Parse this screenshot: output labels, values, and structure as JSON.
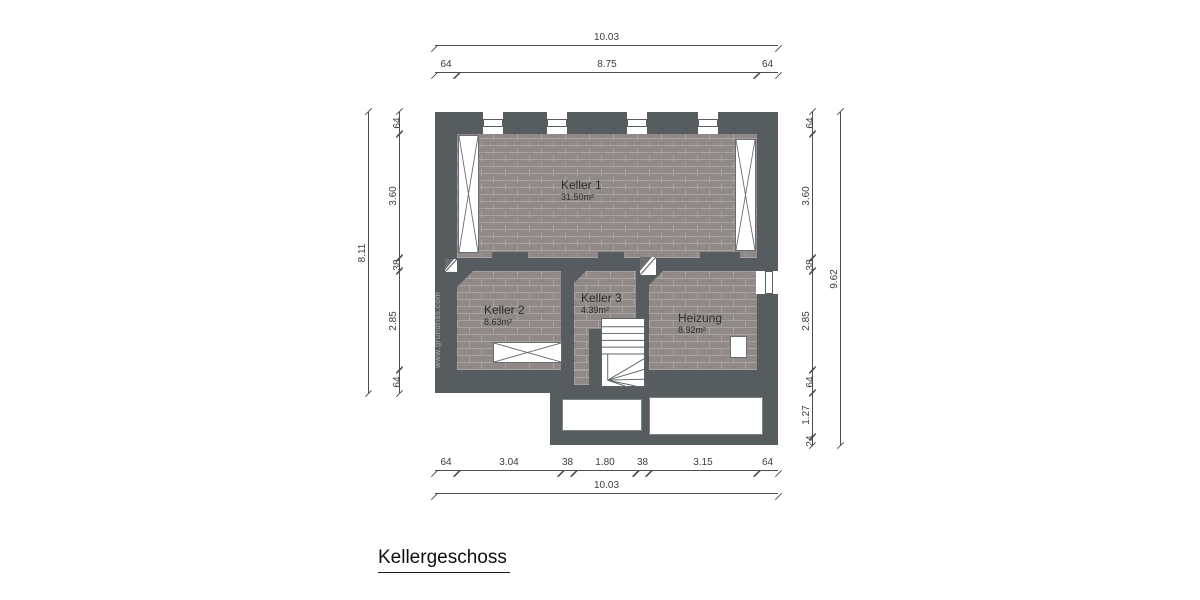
{
  "title": "Kellergeschoss",
  "watermark": "www.grundriss.com",
  "rooms": [
    {
      "name": "Keller 1",
      "area": "31.50m²"
    },
    {
      "name": "Keller 2",
      "area": "8.63m²"
    },
    {
      "name": "Keller 3",
      "area": "4.39m²"
    },
    {
      "name": "Heizung",
      "area": "8.92m²"
    }
  ],
  "dimensions": {
    "top": {
      "total": "10.03",
      "segments": [
        "64",
        "8.75",
        "64"
      ]
    },
    "bottom": {
      "total": "10.03",
      "segments": [
        "64",
        "3.04",
        "38",
        "1.80",
        "38",
        "3.15",
        "64"
      ]
    },
    "left": {
      "total": "8.11",
      "segments": [
        "64",
        "3.60",
        "38",
        "2.85",
        "64"
      ]
    },
    "right": {
      "total": "9.62",
      "segments": [
        "64",
        "3.60",
        "38",
        "2.85",
        "64",
        "1.27",
        "24"
      ]
    }
  },
  "colors": {
    "wall": "#575c5f",
    "brick": "#8f8a87",
    "brick_joint": "#a8a3a0",
    "dimension_line": "#4d4d4d",
    "background": "#ffffff"
  }
}
